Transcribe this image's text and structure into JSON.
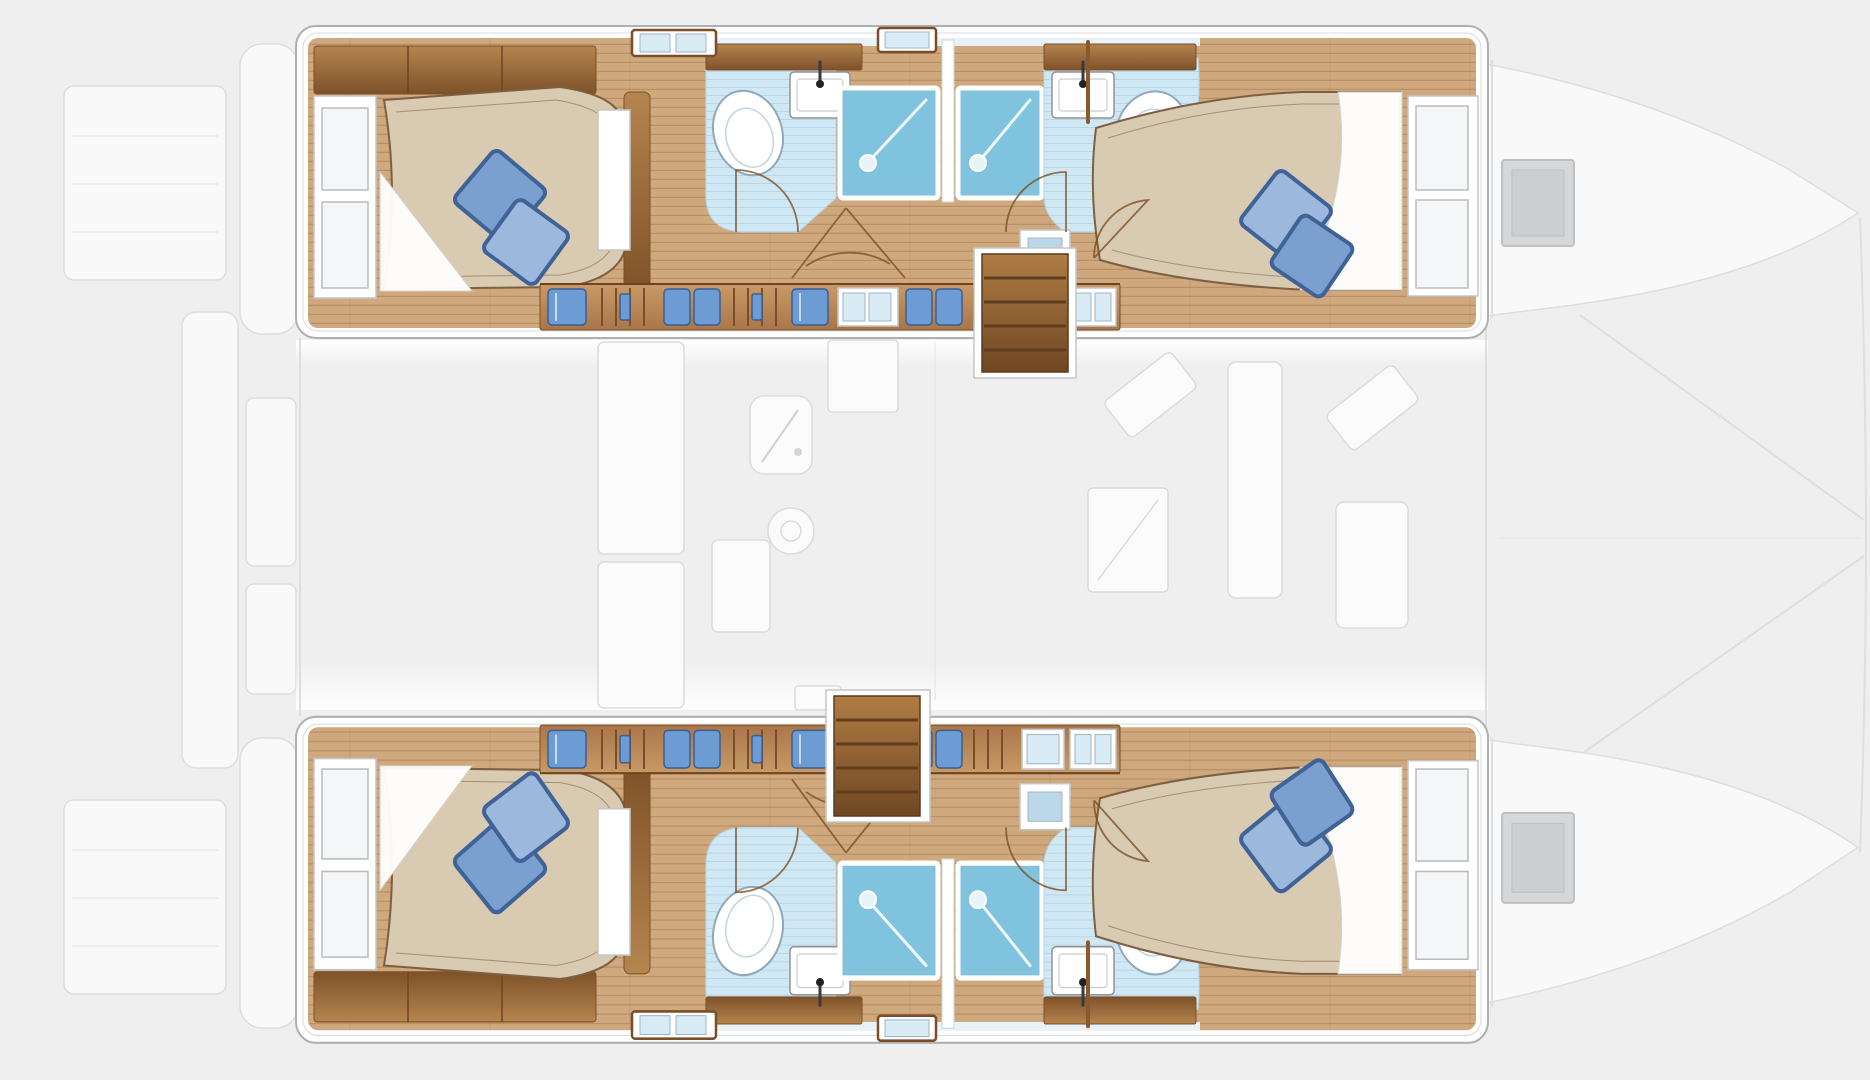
{
  "meta": {
    "document_type": "yacht deck layout diagram",
    "vessel_type": "sailing catamaran",
    "view": "top-down floor plan, bows to the right, sterns to the left",
    "visible_text": "none — drawing only"
  },
  "colors": {
    "bg": "#efeff0",
    "hull": "#ffffff",
    "hullStroke": "#aeb1b3",
    "fadeFill": "#f9f9fa",
    "fadeStroke": "#dddedf",
    "wood": "#cfa87e",
    "woodDark": "#8a5a2e",
    "woodLine": "#7c5026",
    "bandHi": "#c89a66",
    "bandLo": "#a9764a",
    "cabHi": "#b5854f",
    "cabLo": "#7e5129",
    "stairHi": "#b07c44",
    "stairLo": "#6f4722",
    "bed": "#d9cab2",
    "bedLine": "#7d5f41",
    "pillow": "#7ba0cf",
    "pillowLt": "#9db8dd",
    "pillowDark": "#3f6397",
    "bath": "#cfe8f4",
    "shower": "#7fc3de",
    "clothes": "#6d9bd3",
    "clothesDark": "#3a5f94",
    "hatchGray": "#d6d7d8"
  },
  "layout_summary": {
    "hulls": [
      {
        "id": "hull-top",
        "cabins": [
          "aft-double-cabin",
          "forward-double-cabin"
        ],
        "bathrooms": 2,
        "shower_stalls": 2,
        "toilets": 2,
        "sinks": 2,
        "companionway_stairs": 1,
        "wardrobe_lockers": "inboard side band with hanging clothes and windows"
      },
      {
        "id": "hull-bottom",
        "cabins": [
          "aft-double-cabin",
          "forward-double-cabin"
        ],
        "bathrooms": 2,
        "shower_stalls": 2,
        "toilets": 2,
        "sinks": 2,
        "companionway_stairs": 1,
        "wardrobe_lockers": "inboard side band with hanging clothes and windows"
      }
    ],
    "saloon": [
      "galley-counters",
      "galley-sink",
      "round-hob",
      "nav-desk",
      "settee",
      "corner-cushions"
    ],
    "exterior_faded": [
      "stern-swim-platforms",
      "aft-cockpit-bench",
      "cockpit-table",
      "bow-deck-hatches",
      "trampoline-rig-lines"
    ]
  },
  "locker_band_segments": [
    {
      "type": "clothes-single"
    },
    {
      "type": "hangers"
    },
    {
      "type": "clothes-double"
    },
    {
      "type": "hangers"
    },
    {
      "type": "clothes-single"
    },
    {
      "type": "windows"
    },
    {
      "type": "clothes-double"
    },
    {
      "type": "hangers"
    },
    {
      "type": "windows"
    },
    {
      "type": "windows"
    }
  ]
}
